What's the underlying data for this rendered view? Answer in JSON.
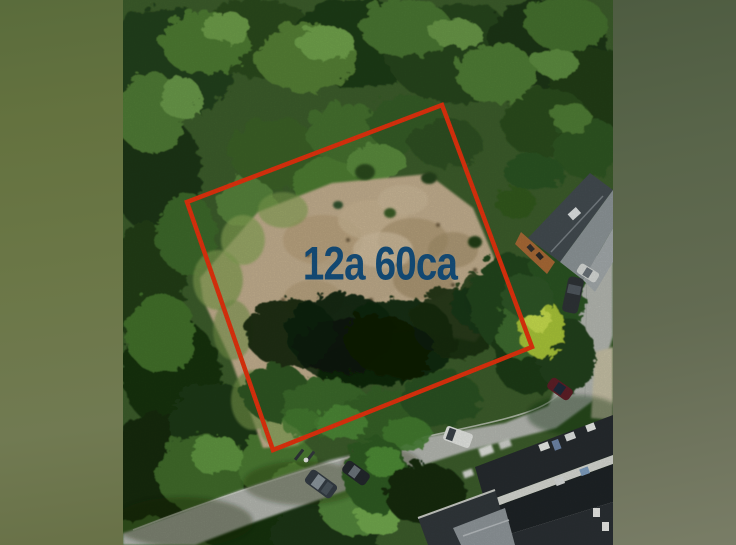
{
  "photo": {
    "area_label": "12a 60ca",
    "label_color": "#15507e",
    "boundary_color": "#e6330e",
    "boundary_points": "319,105 409,347 150,450 64,202"
  }
}
